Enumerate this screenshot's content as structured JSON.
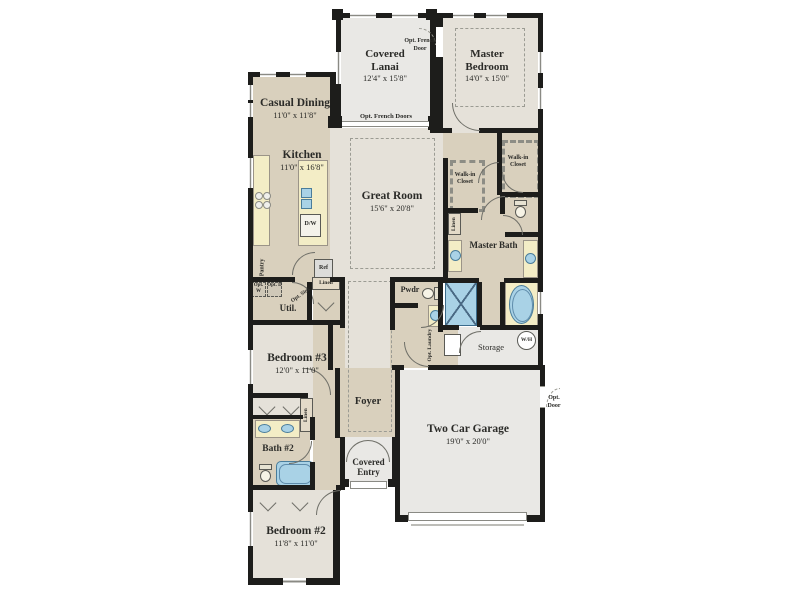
{
  "colors": {
    "wall": "#1d1d1b",
    "floor_tan": "#d9d0bd",
    "floor_light": "#e5e1d9",
    "floor_gray": "#e9e8e5",
    "counter": "#f3edc6",
    "fixture_blue": "#a9d2e6",
    "dash": "#9b9b93",
    "text": "#2b2b28"
  },
  "rooms": {
    "casual_dining": {
      "name": "Casual Dining",
      "dims": "11'0\" x 11'8\""
    },
    "kitchen": {
      "name": "Kitchen",
      "dims": "11'0\" x 16'8\""
    },
    "covered_lanai": {
      "name": "Covered Lanai",
      "dims": "12'4\" x 15'8\""
    },
    "master_bedroom": {
      "name": "Master Bedroom",
      "dims": "14'0\" x 15'0\""
    },
    "great_room": {
      "name": "Great Room",
      "dims": "15'6\" x 20'8\""
    },
    "bedroom3": {
      "name": "Bedroom #3",
      "dims": "12'0\" x 11'0\""
    },
    "bedroom2": {
      "name": "Bedroom #2",
      "dims": "11'8\" x 11'0\""
    },
    "garage": {
      "name": "Two Car Garage",
      "dims": "19'0\" x 20'0\""
    },
    "foyer": {
      "name": "Foyer"
    },
    "covered_entry": {
      "name": "Covered Entry"
    },
    "master_bath": {
      "name": "Master Bath"
    },
    "bath2": {
      "name": "Bath #2"
    },
    "util": {
      "name": "Util."
    },
    "pwdr": {
      "name": "Pwdr"
    },
    "storage": {
      "name": "Storage"
    },
    "walkin_left": {
      "name": "Walk-in Closet"
    },
    "walkin_right": {
      "name": "Walk-in Closet"
    }
  },
  "labels": {
    "pantry": "Pantry",
    "ref": "Ref",
    "dw": "D/W",
    "linen": "Linen",
    "opt_w": "Opt. W",
    "opt_d": "Opt. D",
    "opt_sink": "Opt. Sink",
    "opt_laundry": "Opt. Laundry",
    "opt_french_doors": "Opt. French Doors",
    "opt_french_door": "Opt. French Door",
    "opt_door": "Opt. Door",
    "wh": "W/H"
  }
}
